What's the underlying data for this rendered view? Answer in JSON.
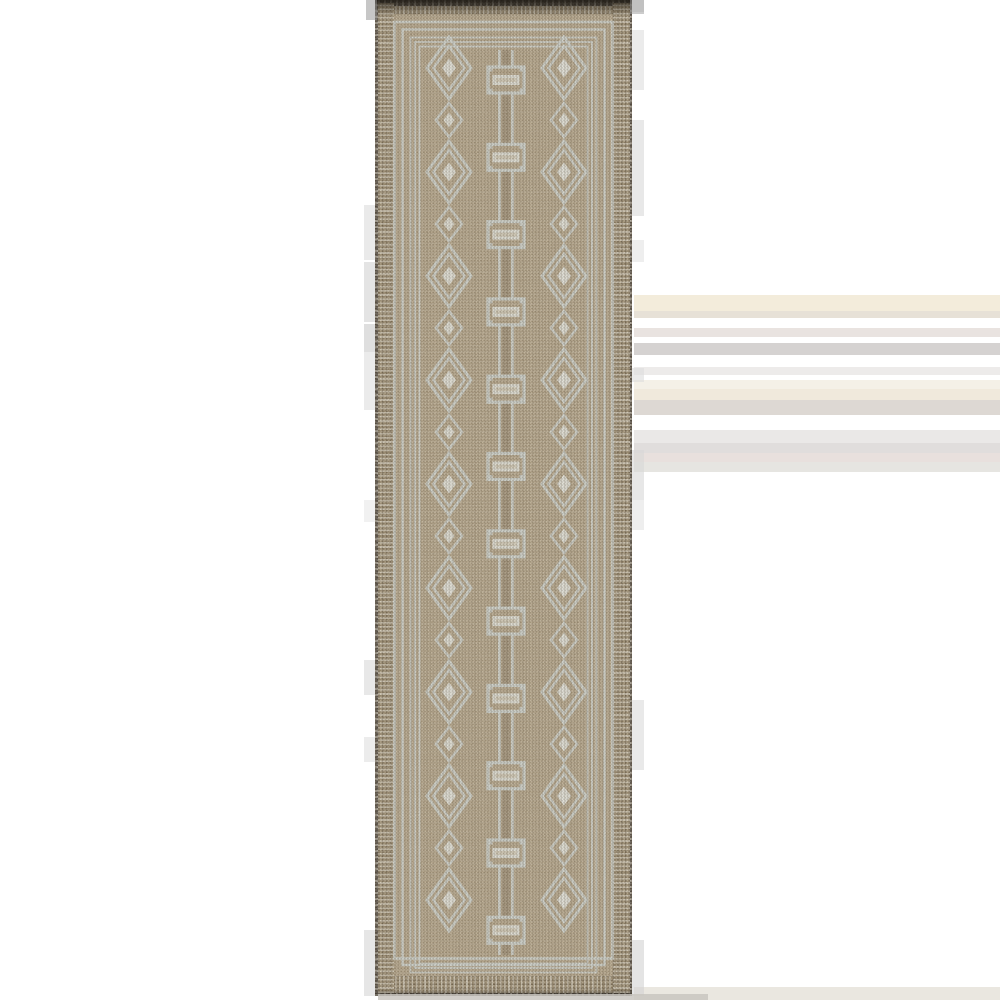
{
  "page": {
    "width": 1000,
    "height": 1000,
    "background": "#ffffff"
  },
  "photo": {
    "subject": "beige-runner-rug-product-photo",
    "rug": {
      "left": 375,
      "top": 0,
      "width": 257,
      "height": 996,
      "colors": {
        "field": "#b2a183",
        "field_light": "#c7b99c",
        "field_dark": "#8f7e61",
        "motif": "#cfd5d0",
        "motif_bright": "#e9ece6",
        "selvedge": "#9c8b6c",
        "edge_dark": "#4a4136",
        "connector_core": "#8a7a5e"
      },
      "bands": [
        {
          "x": 0,
          "y": 0,
          "w": 2.5,
          "h": 996,
          "kind": "edge-v"
        },
        {
          "x": 254.5,
          "y": 0,
          "w": 2.5,
          "h": 996,
          "kind": "edge-v"
        },
        {
          "x": 2.5,
          "y": 3,
          "w": 16.5,
          "h": 990,
          "kind": "braid-v"
        },
        {
          "x": 238,
          "y": 3,
          "w": 16.5,
          "h": 990,
          "kind": "braid-v"
        },
        {
          "x": 2.5,
          "y": 6,
          "w": 252,
          "h": 8,
          "kind": "braid-h"
        },
        {
          "x": 2.5,
          "y": 0,
          "w": 252,
          "h": 6,
          "kind": "edge-h"
        },
        {
          "x": 2.5,
          "y": 976,
          "w": 252,
          "h": 17,
          "kind": "braid-h"
        },
        {
          "x": 6,
          "y": 982,
          "w": 245,
          "h": 4,
          "kind": "dash-row"
        },
        {
          "x": 2.5,
          "y": 993,
          "w": 252,
          "h": 3,
          "kind": "edge-h"
        }
      ],
      "frames": {
        "singles": [
          {
            "x": 19.5,
            "y": 22,
            "w": 218,
            "h": 936.5,
            "sw": 2.6
          },
          {
            "x": 27.5,
            "y": 29.5,
            "w": 202,
            "h": 935.5,
            "sw": 2.4
          }
        ],
        "triple": {
          "x": 35.5,
          "y": 37.5,
          "w": 186,
          "h": 935,
          "sw": 1.8,
          "inset_step": 4.5,
          "count": 3
        }
      },
      "diamond_columns": {
        "centers_x": [
          74,
          189
        ],
        "large": {
          "start_y": 68,
          "period": 104,
          "count": 9,
          "outer_rx": 22,
          "outer_ry": 31,
          "mid_rx": 15.5,
          "mid_ry": 22,
          "dot_rx": 7,
          "dot_ry": 9.5,
          "sw_outer": 3,
          "sw_mid": 2.6
        },
        "small": {
          "start_y": 120,
          "period": 104,
          "count": 8,
          "rx": 13,
          "ry": 17,
          "dot_rx": 5.5,
          "dot_ry": 7.5,
          "sw": 2.6
        }
      },
      "chain": {
        "center_x": 131,
        "field_top": 50,
        "field_bottom": 955,
        "core_w": 8,
        "connector_offset": 6.5,
        "connector_sw": 2.8,
        "links": {
          "start_y": 80,
          "period": 77.3,
          "count": 12,
          "w": 36,
          "h": 26,
          "sw": 3.2,
          "tab": 5.5,
          "bar_w": 27,
          "bar_h": 10
        }
      }
    },
    "artifacts": {
      "right_bands": {
        "x": 634,
        "w": 366,
        "items": [
          {
            "y": 295,
            "h": 16,
            "c": "#f3ecdb"
          },
          {
            "y": 311,
            "h": 7,
            "c": "#e7e1d7"
          },
          {
            "y": 328,
            "h": 9,
            "c": "#e9e3e0"
          },
          {
            "y": 343,
            "h": 12,
            "c": "#d5d2d1"
          },
          {
            "y": 367,
            "h": 8,
            "c": "#edebea"
          },
          {
            "y": 380,
            "h": 9,
            "c": "#f4f0e7"
          },
          {
            "y": 389,
            "h": 11,
            "c": "#f0e9dc"
          },
          {
            "y": 400,
            "h": 15,
            "c": "#ddd8d3"
          },
          {
            "y": 430,
            "h": 13,
            "c": "#eae8e7"
          },
          {
            "y": 443,
            "h": 10,
            "c": "#e0dddc"
          },
          {
            "y": 453,
            "h": 9,
            "c": "#e8e0dd"
          },
          {
            "y": 462,
            "h": 10,
            "c": "#e6e5e1"
          },
          {
            "y": 987,
            "h": 13,
            "c": "#eae7e0"
          }
        ]
      },
      "left_blocks": {
        "x": 364,
        "w": 11,
        "items": [
          {
            "y": 205,
            "h": 55,
            "c": "#dcdcdc"
          },
          {
            "y": 262,
            "h": 60,
            "c": "#d2d2d2"
          },
          {
            "y": 324,
            "h": 28,
            "c": "#c9c9c9"
          },
          {
            "y": 352,
            "h": 58,
            "c": "#dedede"
          },
          {
            "y": 500,
            "h": 22,
            "c": "#e8e8e8"
          },
          {
            "y": 660,
            "h": 35,
            "c": "#d8d8d8"
          },
          {
            "y": 737,
            "h": 25,
            "c": "#dfdfdf"
          },
          {
            "y": 930,
            "h": 66,
            "c": "#d6d6d6"
          }
        ]
      },
      "right_blocks": {
        "x": 632,
        "w": 12,
        "items": [
          {
            "y": 0,
            "h": 12,
            "c": "#d8d8d8"
          },
          {
            "y": 30,
            "h": 60,
            "c": "#dddddd"
          },
          {
            "y": 120,
            "h": 96,
            "c": "#d9d9d9"
          },
          {
            "y": 240,
            "h": 22,
            "c": "#e2e2e2"
          },
          {
            "y": 368,
            "h": 14,
            "c": "#dcdcdc"
          },
          {
            "y": 450,
            "h": 50,
            "c": "#d7d7d7"
          },
          {
            "y": 500,
            "h": 30,
            "c": "#e3e3e3"
          },
          {
            "y": 700,
            "h": 70,
            "c": "#dadada"
          },
          {
            "y": 940,
            "h": 56,
            "c": "#d2d2d2"
          }
        ]
      },
      "corner_shadows": [
        {
          "x": 366,
          "y": 0,
          "w": 11,
          "h": 20,
          "c": "#8f8f8f"
        },
        {
          "x": 630,
          "y": 0,
          "w": 14,
          "h": 14,
          "c": "#9a9a9a"
        }
      ],
      "bottom_shadow": {
        "x": 378,
        "y": 994,
        "w": 330,
        "h": 6,
        "c": "#c9c6bf"
      }
    }
  }
}
